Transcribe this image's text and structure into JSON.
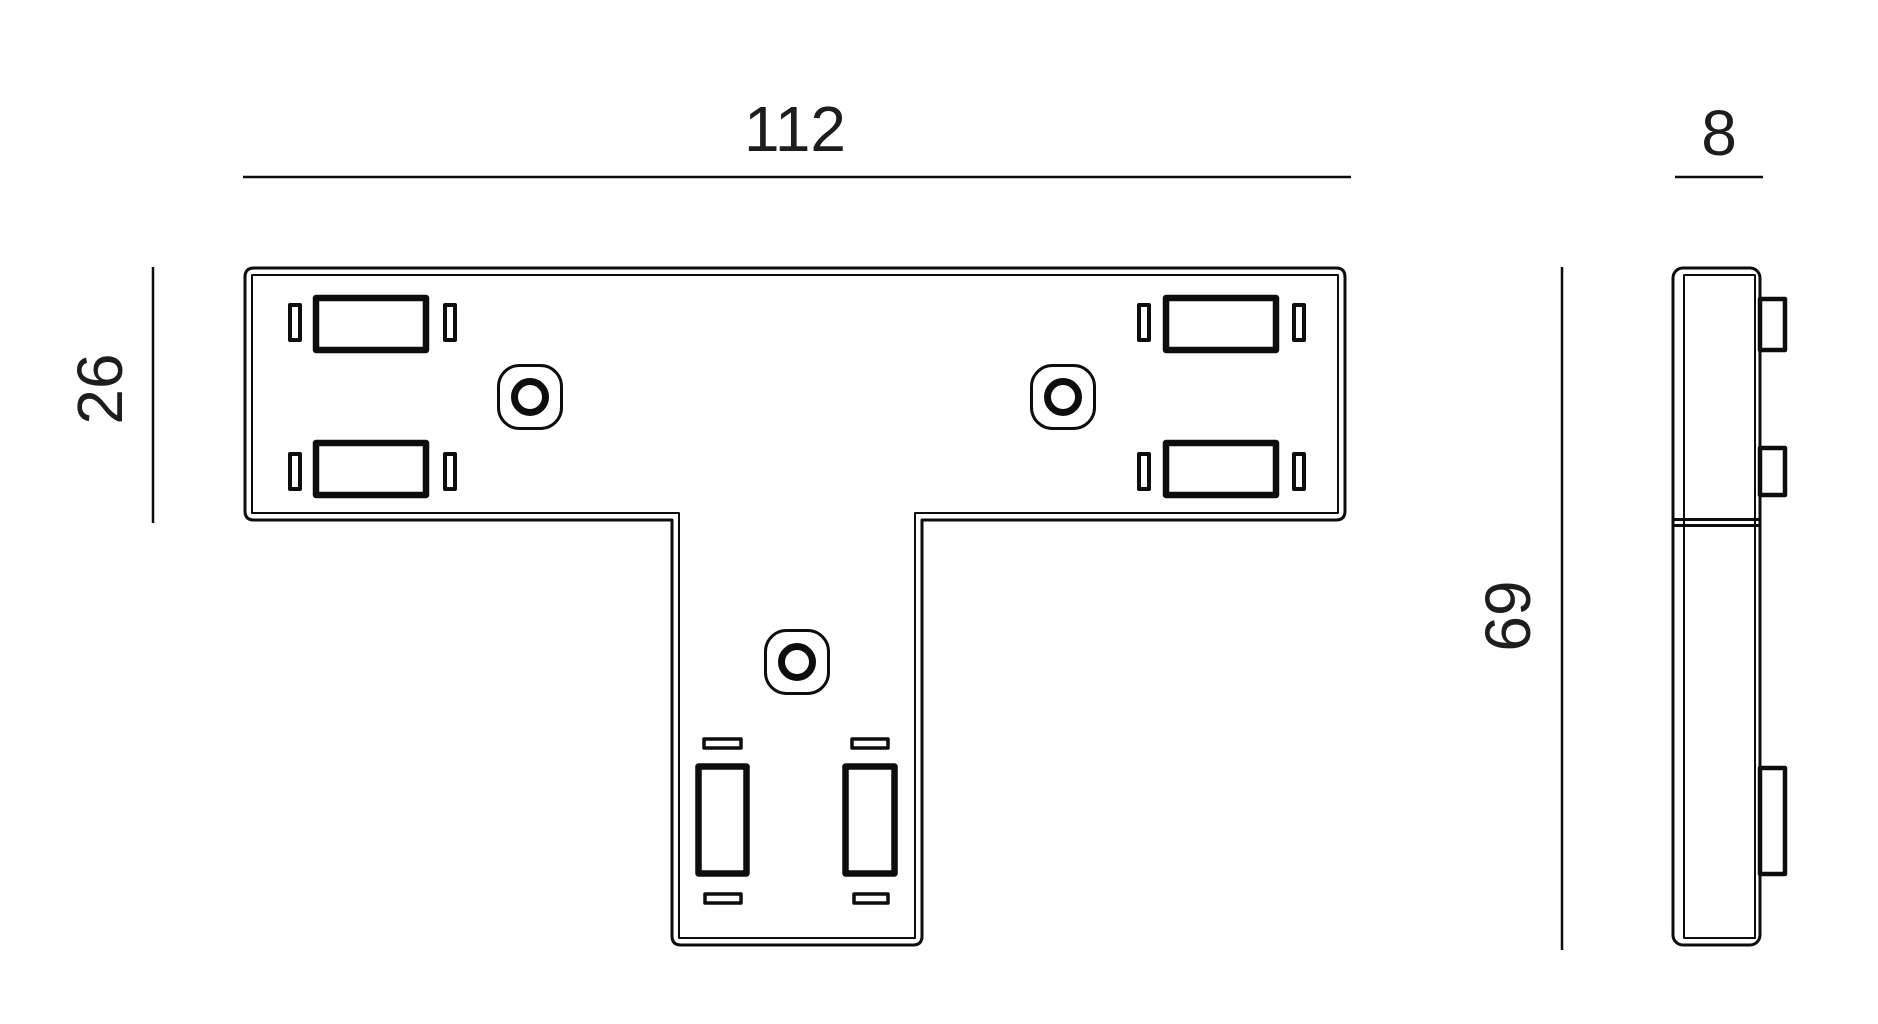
{
  "drawing": {
    "dimensions": {
      "width_mm": "112",
      "bar_height_mm": "26",
      "total_height_mm": "69",
      "depth_mm": "8"
    },
    "colors": {
      "line": "#0d0d0d",
      "text": "#1d1d1b",
      "background": "#ffffff"
    }
  }
}
